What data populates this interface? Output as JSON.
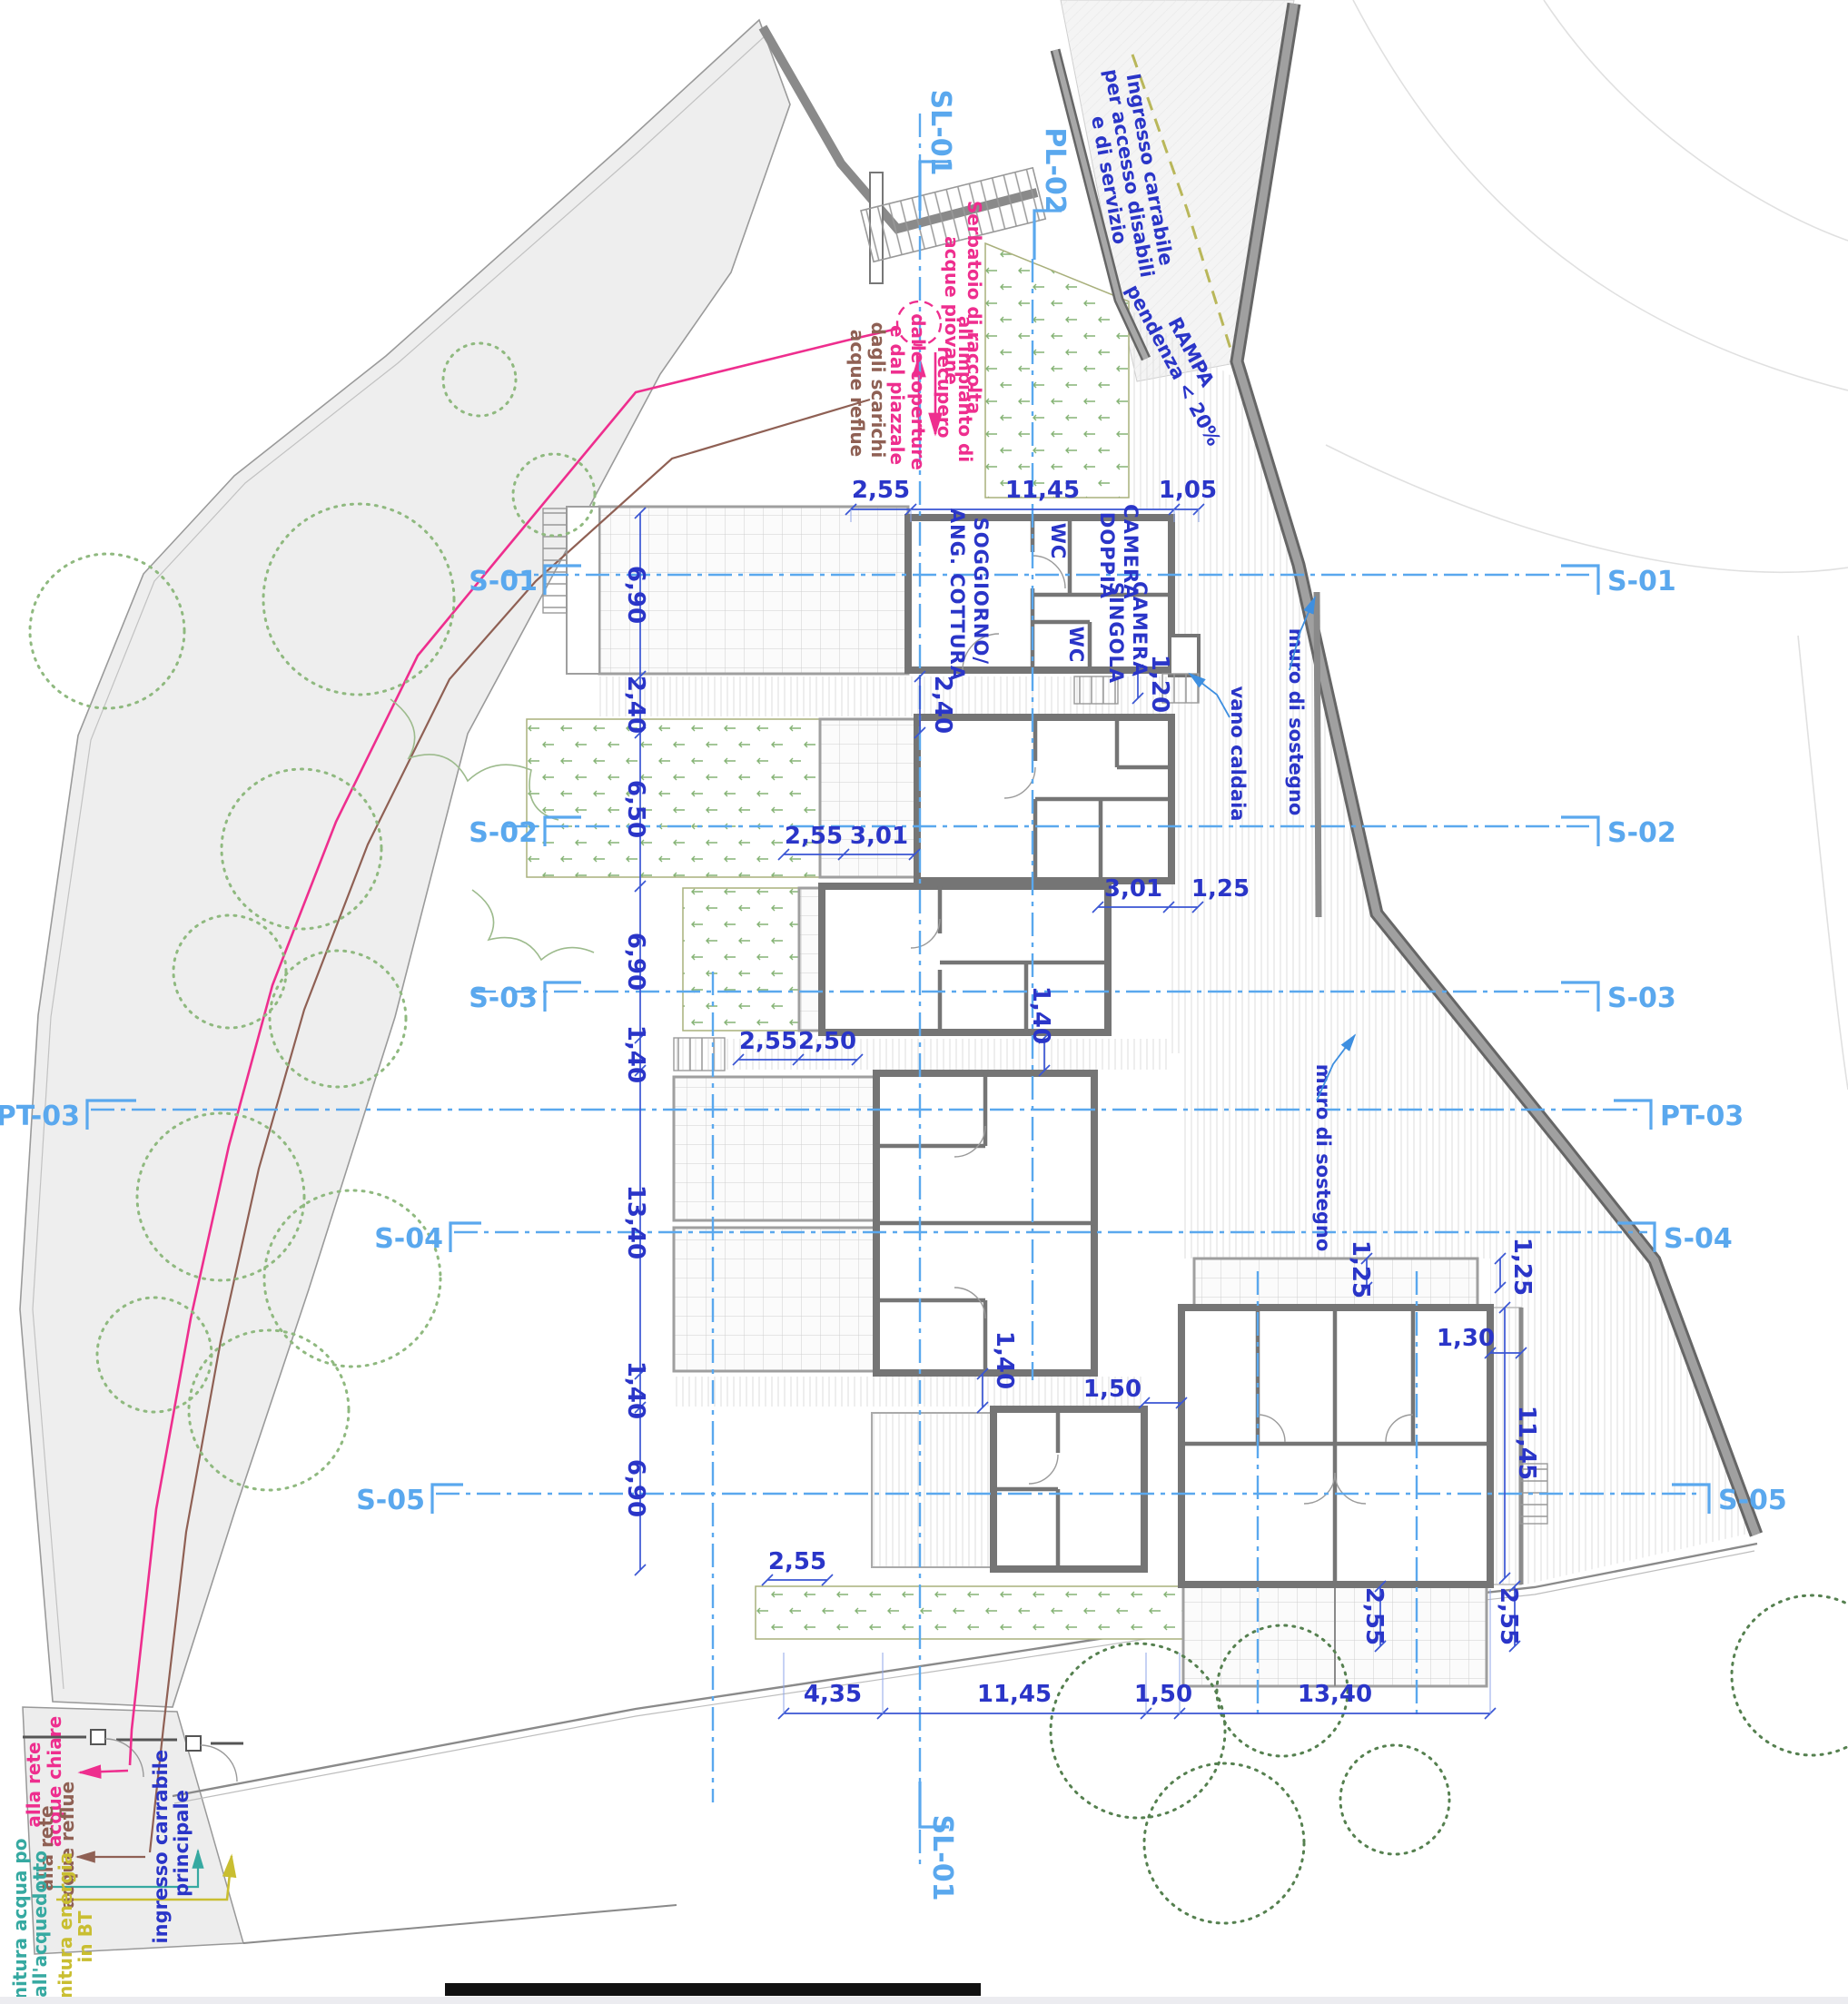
{
  "markers": {
    "sections_left": [
      "S-01",
      "S-02",
      "S-03",
      "PT-03",
      "S-04",
      "S-05"
    ],
    "sections_right": [
      "S-01",
      "S-02",
      "S-03",
      "PT-03",
      "S-04",
      "S-05"
    ],
    "axis_top": [
      "SL-01",
      "PL-02"
    ],
    "axis_bottom": "SL-01"
  },
  "dims": {
    "top": [
      "2,55",
      "11,45",
      "1,05"
    ],
    "left": [
      "6,90",
      "2,40",
      "6,50",
      "6,90",
      "1,40",
      "13,40",
      "1,40",
      "6,90"
    ],
    "bottom": [
      "4,35",
      "11,45",
      "1,50",
      "13,40"
    ],
    "u1_gap": "2,40",
    "u1_right": "1,20",
    "u2": [
      "2,55",
      "3,01"
    ],
    "u2_right": [
      "3,01",
      "1,25"
    ],
    "u3": [
      "2,55",
      "2,50"
    ],
    "u3_right": "1,40",
    "u4_gap": "1,40",
    "u5_gap": "1,50",
    "u6_top": [
      "1,25",
      "1,25"
    ],
    "u6_side": "1,30",
    "u6_height": "11,45",
    "u5_terrace": "2,55",
    "u6_terraces": [
      "2,55",
      "2,55"
    ]
  },
  "rooms": {
    "living": [
      "SOGGIORNO/",
      "ANG. COTTURA"
    ],
    "wc1": "WC",
    "wc2": "WC",
    "double": [
      "CAMERA",
      "DOPPIA"
    ],
    "single": [
      "CAMERA",
      "SINGOLA"
    ]
  },
  "notes": {
    "vano_caldaia": "vano caldaia",
    "muro1": "muro di sostegno",
    "muro2": "muro di sostegno",
    "rampa": [
      "RAMPA",
      "pendenza < 20%"
    ],
    "serbatoio": [
      "Serbatoio di raccolta",
      "acque piovane"
    ],
    "impianto": [
      "all'impianto di",
      "recupero"
    ],
    "coperture": [
      "dalle coperture",
      "e dal piazzale"
    ],
    "scarichi": [
      "dagli scarichi",
      "acque reflue"
    ],
    "ingresso_disabili": [
      "Ingresso carrabile",
      "per accesso disabili",
      "e di servizio"
    ],
    "rete_chiare": [
      "alla rete",
      "acque chiare"
    ],
    "rete_reflue": [
      "alla rete",
      "acque reflue"
    ],
    "ingresso_principale": [
      "ingresso carrabile",
      "principale"
    ],
    "fornitura_acqua": [
      "fornitura acqua po",
      "dall'acquedotto"
    ],
    "fornitura_energia": [
      "fornitura energia",
      "in BT"
    ]
  },
  "colors": {
    "dim_blue": "#2a35c8",
    "section_blue": "#5aa8ee",
    "pink": "#ee2e8e",
    "brown": "#8f6054",
    "teal": "#36a9a1",
    "yellow": "#c9be31",
    "wall_gray": "#757575",
    "tree_green": "#8fb97f"
  }
}
